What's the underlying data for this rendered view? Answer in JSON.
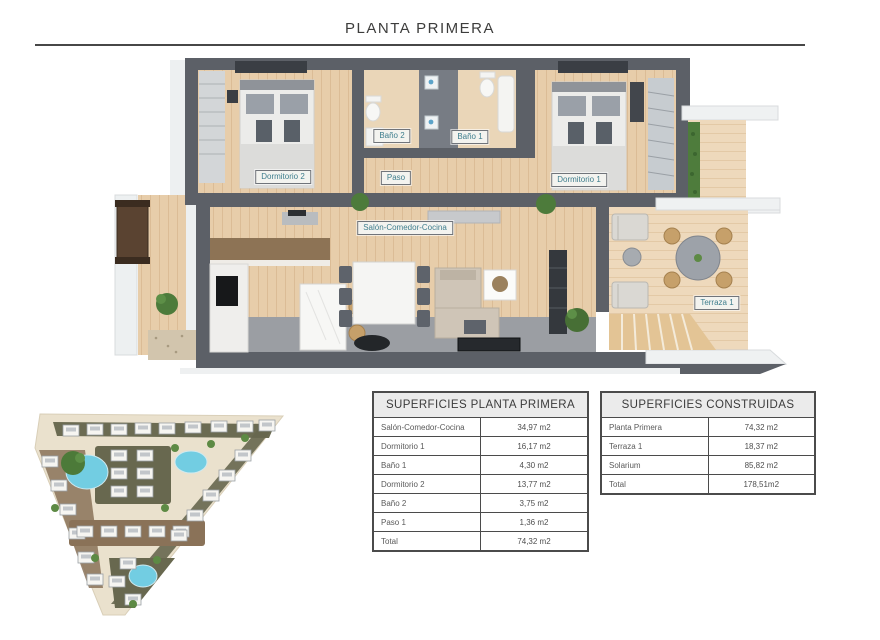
{
  "page": {
    "title": "PLANTA PRIMERA"
  },
  "floor_plan": {
    "labels": {
      "dormitorio2": "Dormitorio 2",
      "bano2": "Baño 2",
      "bano1": "Baño 1",
      "paso": "Paso",
      "dormitorio1": "Dormitorio 1",
      "salon": "Salón-Comedor-Cocina",
      "terraza": "Terraza 1"
    }
  },
  "tables": {
    "superficies_planta": {
      "title": "SUPERFICIES PLANTA PRIMERA",
      "rows": [
        {
          "label": "Salón-Comedor-Cocina",
          "value": "34,97 m2"
        },
        {
          "label": "Dormitorio 1",
          "value": "16,17 m2"
        },
        {
          "label": "Baño 1",
          "value": "4,30 m2"
        },
        {
          "label": "Dormitorio 2",
          "value": "13,77 m2"
        },
        {
          "label": "Baño 2",
          "value": "3,75 m2"
        },
        {
          "label": "Paso 1",
          "value": "1,36 m2"
        },
        {
          "label": "Total",
          "value": "74,32 m2"
        }
      ]
    },
    "superficies_construidas": {
      "title": "SUPERFICIES CONSTRUIDAS",
      "rows": [
        {
          "label": "Planta Primera",
          "value": "74,32 m2"
        },
        {
          "label": "Terraza 1",
          "value": "18,37 m2"
        },
        {
          "label": "Solarium",
          "value": "85,82 m2"
        },
        {
          "label": "Total",
          "value": "178,51m2"
        }
      ]
    }
  },
  "colors": {
    "label_text": "#3f7e8d",
    "wall": "#5c6067",
    "wood_floor": "#e7cdaa",
    "terrace_floor": "#eed9bc",
    "concrete": "#9b9ea3",
    "pool": "#72cde2",
    "hedge_green": "#4e7c3c",
    "road": "#eae1cd",
    "table_header_bg": "#ebebeb",
    "rule": "#474747"
  }
}
